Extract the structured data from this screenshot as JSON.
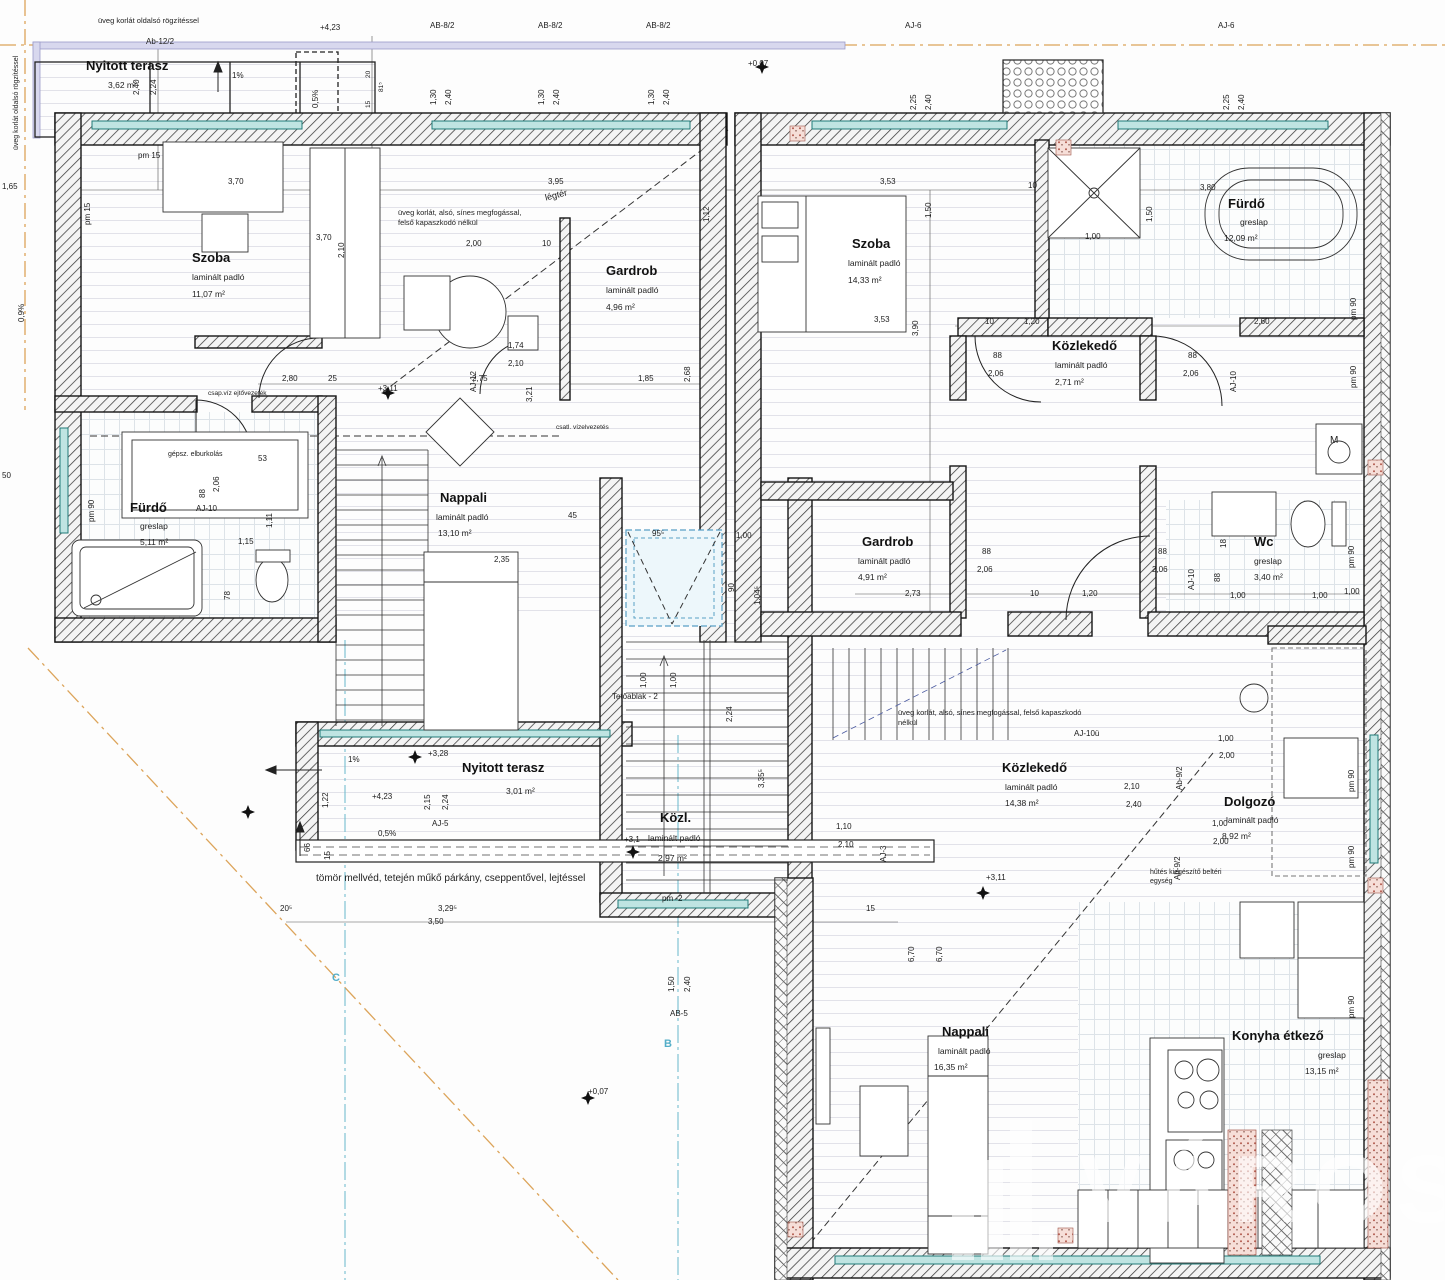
{
  "drawing_type": "architectural floor plan (emeleti alaprajz)",
  "watermark": {
    "text": "VÁROS"
  },
  "axes": {
    "b": "B",
    "c": "C"
  },
  "rooms": [
    {
      "name": "Nyitott terasz",
      "area": "3,62 m²"
    },
    {
      "name": "Szoba",
      "floor": "laminált padló",
      "area": "11,07 m²"
    },
    {
      "name": "Gardrob",
      "floor": "laminált padló",
      "area": "4,96 m²"
    },
    {
      "name": "Szoba",
      "floor": "laminált padló",
      "area": "14,33 m²"
    },
    {
      "name": "Fürdő",
      "floor": "greslap",
      "area": "12,09 m²"
    },
    {
      "name": "Közlekedő",
      "floor": "laminált padló",
      "area": "2,71 m²"
    },
    {
      "name": "Fürdő",
      "floor": "greslap",
      "area": "5,11 m²"
    },
    {
      "name": "Nappali",
      "floor": "laminált padló",
      "area": "13,10 m²"
    },
    {
      "name": "Gardrob",
      "floor": "laminált padló",
      "area": "4,91 m²"
    },
    {
      "name": "Wc",
      "floor": "greslap",
      "area": "3,40 m²"
    },
    {
      "name": "Nyitott terasz",
      "area": "3,01 m²"
    },
    {
      "name": "Közl.",
      "floor": "laminált padló",
      "area": "2,97 m²"
    },
    {
      "name": "Közlekedő",
      "floor": "laminált padló",
      "area": "14,38 m²"
    },
    {
      "name": "Dolgozó",
      "floor": "laminált padló",
      "area": "8,92 m²"
    },
    {
      "name": "Nappali",
      "floor": "laminált padló",
      "area": "16,35 m²"
    },
    {
      "name": "Konyha étkező",
      "floor": "greslap",
      "area": "13,15 m²"
    }
  ],
  "notes": {
    "glass_top": "üveg korlát oldalsó rögzítéssel",
    "glass_left": "üveg korlát oldalsó rögzítéssel",
    "glass_rail_top": "üveg korlát, alsó, sínes megfogással, felső kapaszkodó nélkül",
    "glass_rail_right": "üveg korlát, alsó, sínes megfogással, felső kapaszkodó nélkül",
    "airspace": "légtér",
    "water_drain": "csap.víz ejtővezeték",
    "mech_cover": "gépsz. elburkolás",
    "drain_conn": "csatl. vízelvezetés",
    "skylight": "Tetőablak - 2",
    "parapet": "tömör mellvéd, tetején műkő párkány, cseppentővel, lejtéssel",
    "cooling": "hűtés kiegészítő beltéri egység"
  },
  "dims": [
    "+4,23",
    "Ab-12/2",
    "2,40",
    "2,24",
    "1%",
    "0,5%",
    "AB-8/2",
    "1,30",
    "2,40",
    "AB-8/2",
    "1,30",
    "2,40",
    "AB-8/2",
    "1,30",
    "2,40",
    "+0,07",
    "AJ-6",
    "2,25",
    "2,40",
    "AJ-6",
    "2,25",
    "2,40",
    "20",
    "81⁵",
    "15",
    "1,65",
    "pm 15",
    "pm 15",
    "0,9%",
    "3,70",
    "3,95",
    "1,12",
    "3,53",
    "1,50",
    "10",
    "3,80",
    "1,50",
    "2,10",
    "3,70",
    "2,00",
    "10",
    "2,68",
    "2,80",
    "25",
    "+3,11",
    "2,75",
    "1,85",
    "AJ-12",
    "1,74",
    "2,10",
    "3,21",
    "3,53",
    "3,90",
    "1,00",
    "1,20",
    "2,60",
    "10",
    "88",
    "2,06",
    "88",
    "2,06",
    "AJ-10",
    "pm 90",
    "pm 90",
    "50",
    "pm 90",
    "53",
    "1,11",
    "88",
    "2,06",
    "AJ-10",
    "1,15",
    "78",
    "2,35",
    "45",
    "95⁵",
    "1,00",
    "1,00",
    "90",
    "1,00",
    "2,24",
    "1,04⁵",
    "3,35⁵",
    "88",
    "2,06",
    "88",
    "2,06",
    "AJ-10",
    "2,73",
    "1,20",
    "10",
    "1,00",
    "1,00",
    "1,00",
    "pm 90",
    "88",
    "18",
    "1,22",
    "2,15",
    "2,24",
    "+3,28",
    "1%",
    "+4,23",
    "AJ-5",
    "0,5%",
    "66",
    "15",
    "3,29⁵",
    "3,50",
    "20⁵",
    "15",
    "+0,07",
    "1,50",
    "2,40",
    "AB-5",
    "1,10",
    "2,10",
    "AJ-3",
    "6,70",
    "6,70",
    "+3,11",
    "2,10",
    "2,40",
    "1,00",
    "2,00",
    "Ab-9/2",
    "1,00",
    "2,00",
    "Ab-9/2",
    "pm 90",
    "pm 90",
    "pm 90",
    "AJ-10ü",
    "+3,1",
    "pm -2",
    "M"
  ]
}
